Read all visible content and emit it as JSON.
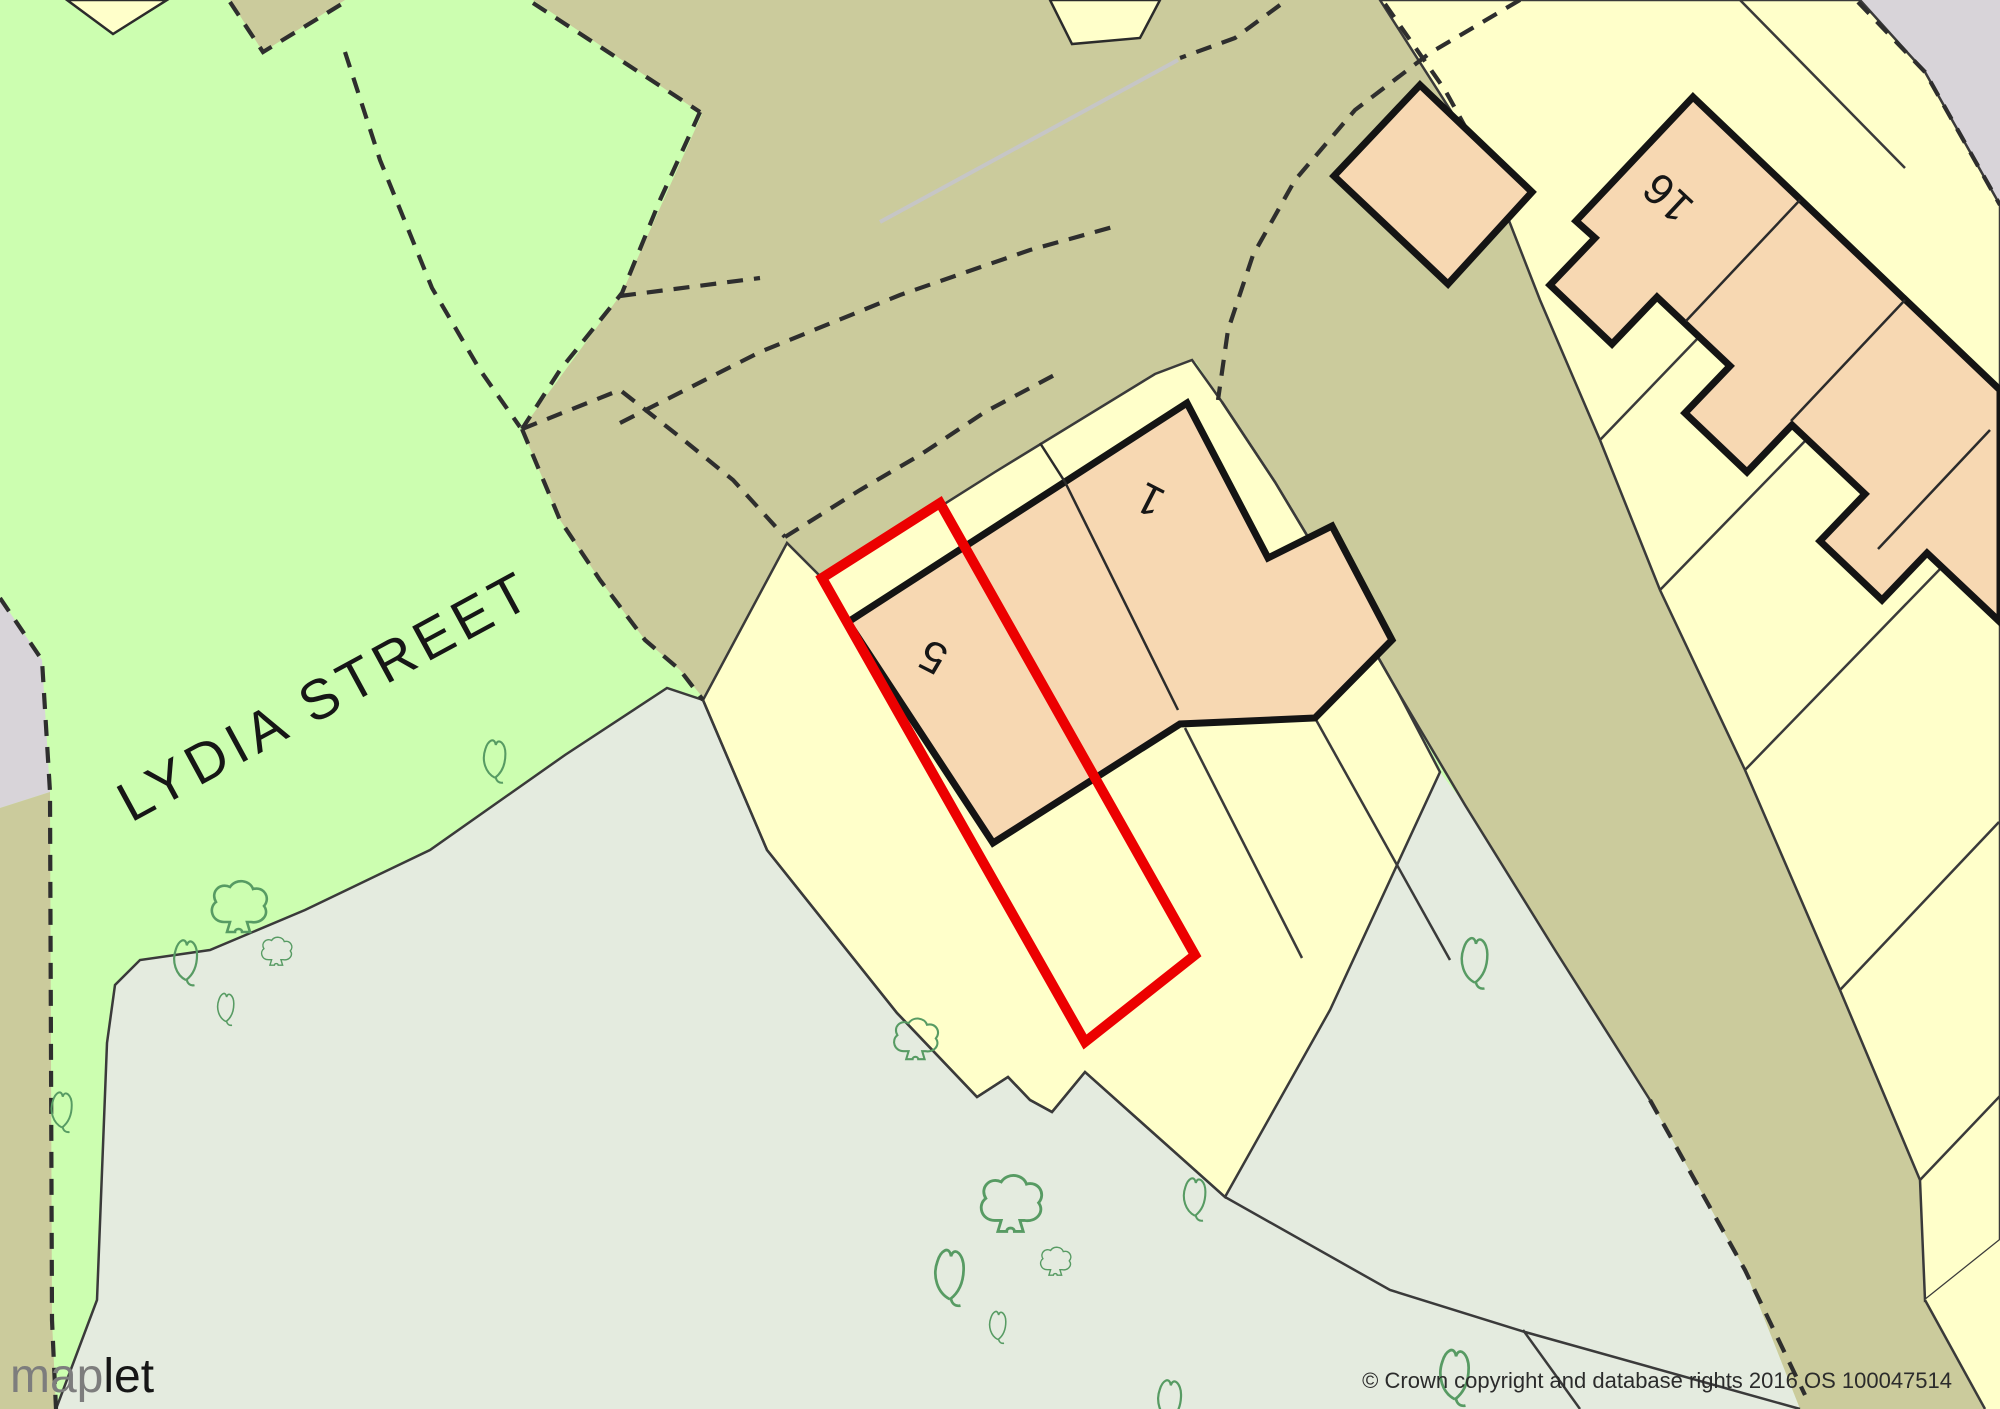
{
  "map": {
    "street_name": "LYDIA STREET",
    "house_numbers": {
      "plot5": "5",
      "plot1": "1",
      "plot16": "16"
    },
    "selected_plot": {
      "number": "5",
      "outline_color": "#ec0000"
    },
    "colors": {
      "greenspace": "#ccfeb0",
      "road": "#cbcb9c",
      "parcel": "#ffffca",
      "building": "#f7d8b2",
      "scrub": "#e4ebdf",
      "unmapped": "#d8d4d9",
      "tree_outline": "#579b63",
      "building_outline": "#141414"
    }
  },
  "branding": {
    "logo_prefix": "map",
    "logo_suffix": "let"
  },
  "attribution": {
    "copyright": "© Crown copyright and database rights 2016 OS 100047514"
  }
}
